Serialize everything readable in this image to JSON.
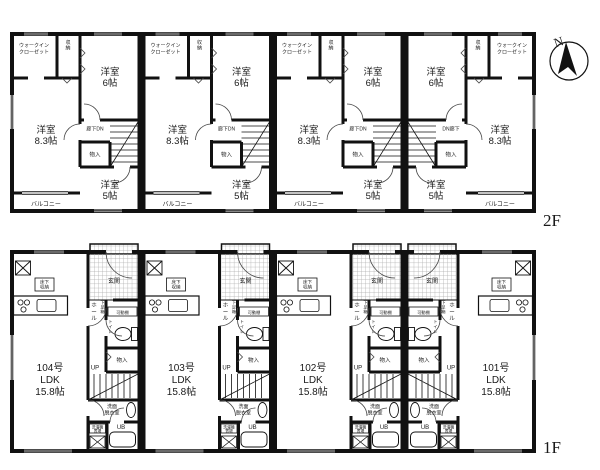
{
  "compass": {
    "north": "N"
  },
  "f2": {
    "floor_label": "2F",
    "rooms": {
      "wic_l1": "ウォークイン",
      "wic_l2": "クローゼット",
      "closet": "収納",
      "room6_l1": "洋室",
      "room6_l2": "6帖",
      "room83_l1": "洋室",
      "room83_l2": "8.3帖",
      "room5_l1": "洋室",
      "room5_l2": "5帖",
      "corridor_dn": "廊下DN",
      "dn_corridor": "DN廊下",
      "storage": "物入",
      "balcony": "バルコニー"
    }
  },
  "f1": {
    "floor_label": "1F",
    "rooms": {
      "genkan": "玄関",
      "hall": "ホール",
      "shoe_box": "下足箱",
      "shelf": "可動棚",
      "toilet": "トイレ",
      "storage": "物入",
      "up": "UP",
      "washroom_l1": "洗面",
      "washroom_l2": "脱衣室",
      "laundry_l1": "洗濯機",
      "laundry_l2": "置場",
      "bath": "UB",
      "floor_storage_l1": "床下",
      "floor_storage_l2": "収納",
      "ldk": "LDK",
      "ldk_size": "15.8帖"
    },
    "units": [
      {
        "number": "104号"
      },
      {
        "number": "103号"
      },
      {
        "number": "102号"
      },
      {
        "number": "101号"
      }
    ]
  }
}
